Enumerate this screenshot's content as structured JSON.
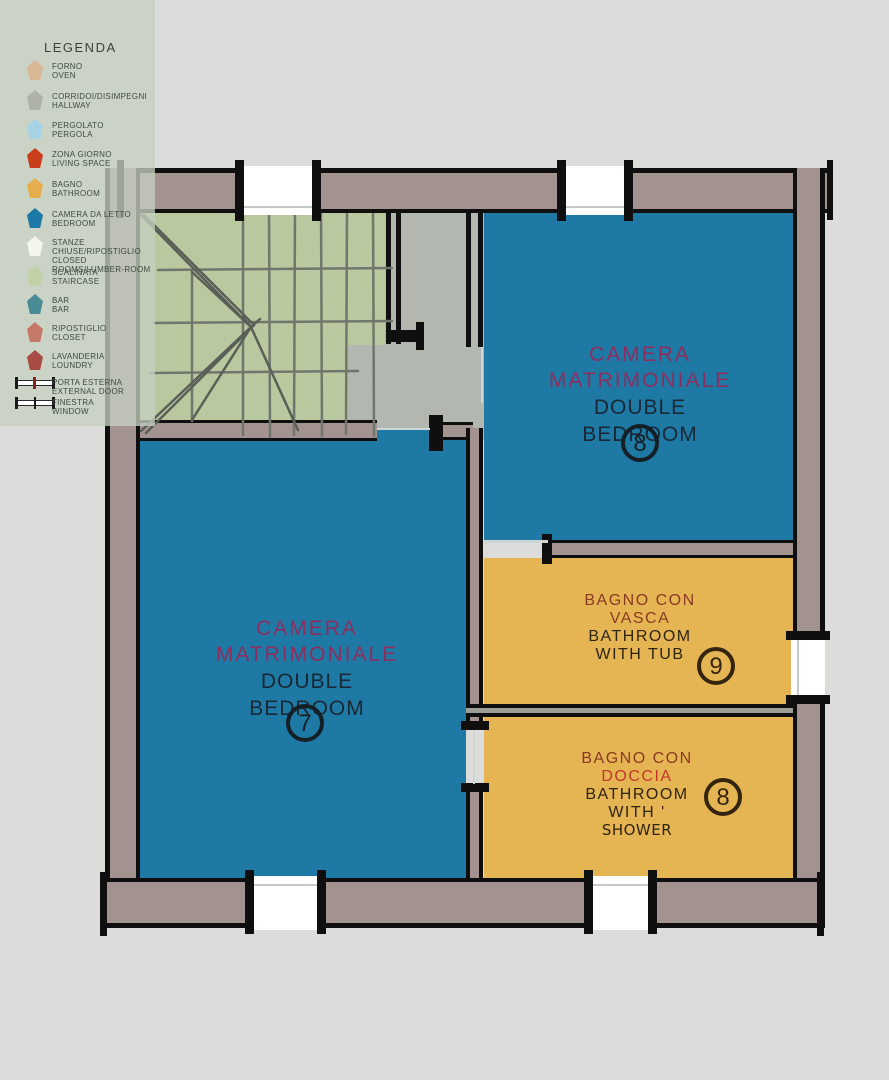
{
  "legend": {
    "title": "LEGENDA",
    "items": [
      {
        "name": "forno",
        "color": "#d8b794",
        "line1": "FORNO",
        "line2": "OVEN"
      },
      {
        "name": "corridoi",
        "color": "#aeb2aa",
        "line1": "CORRIDOI/DISIMPEGNI",
        "line2": "HALLWAY"
      },
      {
        "name": "pergolato",
        "color": "#a6d2e6",
        "line1": "PERGOLATO",
        "line2": "PERGOLA"
      },
      {
        "name": "zona-giorno",
        "color": "#c93d1b",
        "line1": "ZONA GIORNO",
        "line2": "LIVING SPACE"
      },
      {
        "name": "bagno",
        "color": "#e6ae4d",
        "line1": "BAGNO",
        "line2": "BATHROOM"
      },
      {
        "name": "camera-da-letto",
        "color": "#1d79a7",
        "line1": "CAMERA DA LETTO",
        "line2": "BEDROOM"
      },
      {
        "name": "stanze-chiuse",
        "color": "#f5f5f0",
        "line1": "STANZE CHIUSE/RIPOSTIGLIO",
        "line2": "CLOSED ROOMS/LUMBER-ROOM"
      },
      {
        "name": "scalinata",
        "color": "#c0d2a6",
        "line1": "SCALINATA",
        "line2": "STAIRCASE"
      },
      {
        "name": "bar",
        "color": "#4b8b95",
        "line1": "BAR",
        "line2": "BAR"
      },
      {
        "name": "ripostiglio",
        "color": "#c67868",
        "line1": "RIPOSTIGLIO",
        "line2": "CLOSET"
      },
      {
        "name": "lavanderia",
        "color": "#a74b45",
        "line1": "LAVANDERIA",
        "line2": "LOUNDRY"
      }
    ],
    "symbol_items": [
      {
        "name": "porta-esterna",
        "line1": "PORTA ESTERNA",
        "line2": "EXTERNAL DOOR"
      },
      {
        "name": "finestra",
        "line1": "FINESTRA",
        "line2": "WINDOW"
      }
    ]
  },
  "rooms": {
    "bedroom8": {
      "line1": "CAMERA",
      "line2": "MATRIMONIALE",
      "line3": "DOUBLE BEDROOM",
      "number": "8"
    },
    "bedroom7": {
      "line1": "CAMERA",
      "line2": "MATRIMONIALE",
      "line3": "DOUBLE BEDROOM",
      "number": "7"
    },
    "bath9": {
      "line1": "BAGNO CON",
      "line2": "VASCA",
      "line3": "BATHROOM",
      "line4": "WITH TUB",
      "number": "9"
    },
    "bath8": {
      "line1": "BAGNO CON",
      "line2": "DOCCIA",
      "line3": "BATHROOM",
      "line4": "WITH '",
      "line5": "SHOWER",
      "number": "8"
    }
  },
  "colors": {
    "background": "#dcdddb",
    "bedroom_fill": "#1e7aa4",
    "bathroom_fill": "#e6b553",
    "staircase_fill": "#b9c89e",
    "hallway_fill": "#b2b8af",
    "wall_fill": "#a29290",
    "wall_line": "#0f0f0f",
    "legend_bg": "#c7cfc3",
    "title_magenta": "#8e2d5e",
    "title_navy": "#1a2836",
    "bath_brown": "#8a3a22",
    "bath_red": "#c2372a"
  }
}
